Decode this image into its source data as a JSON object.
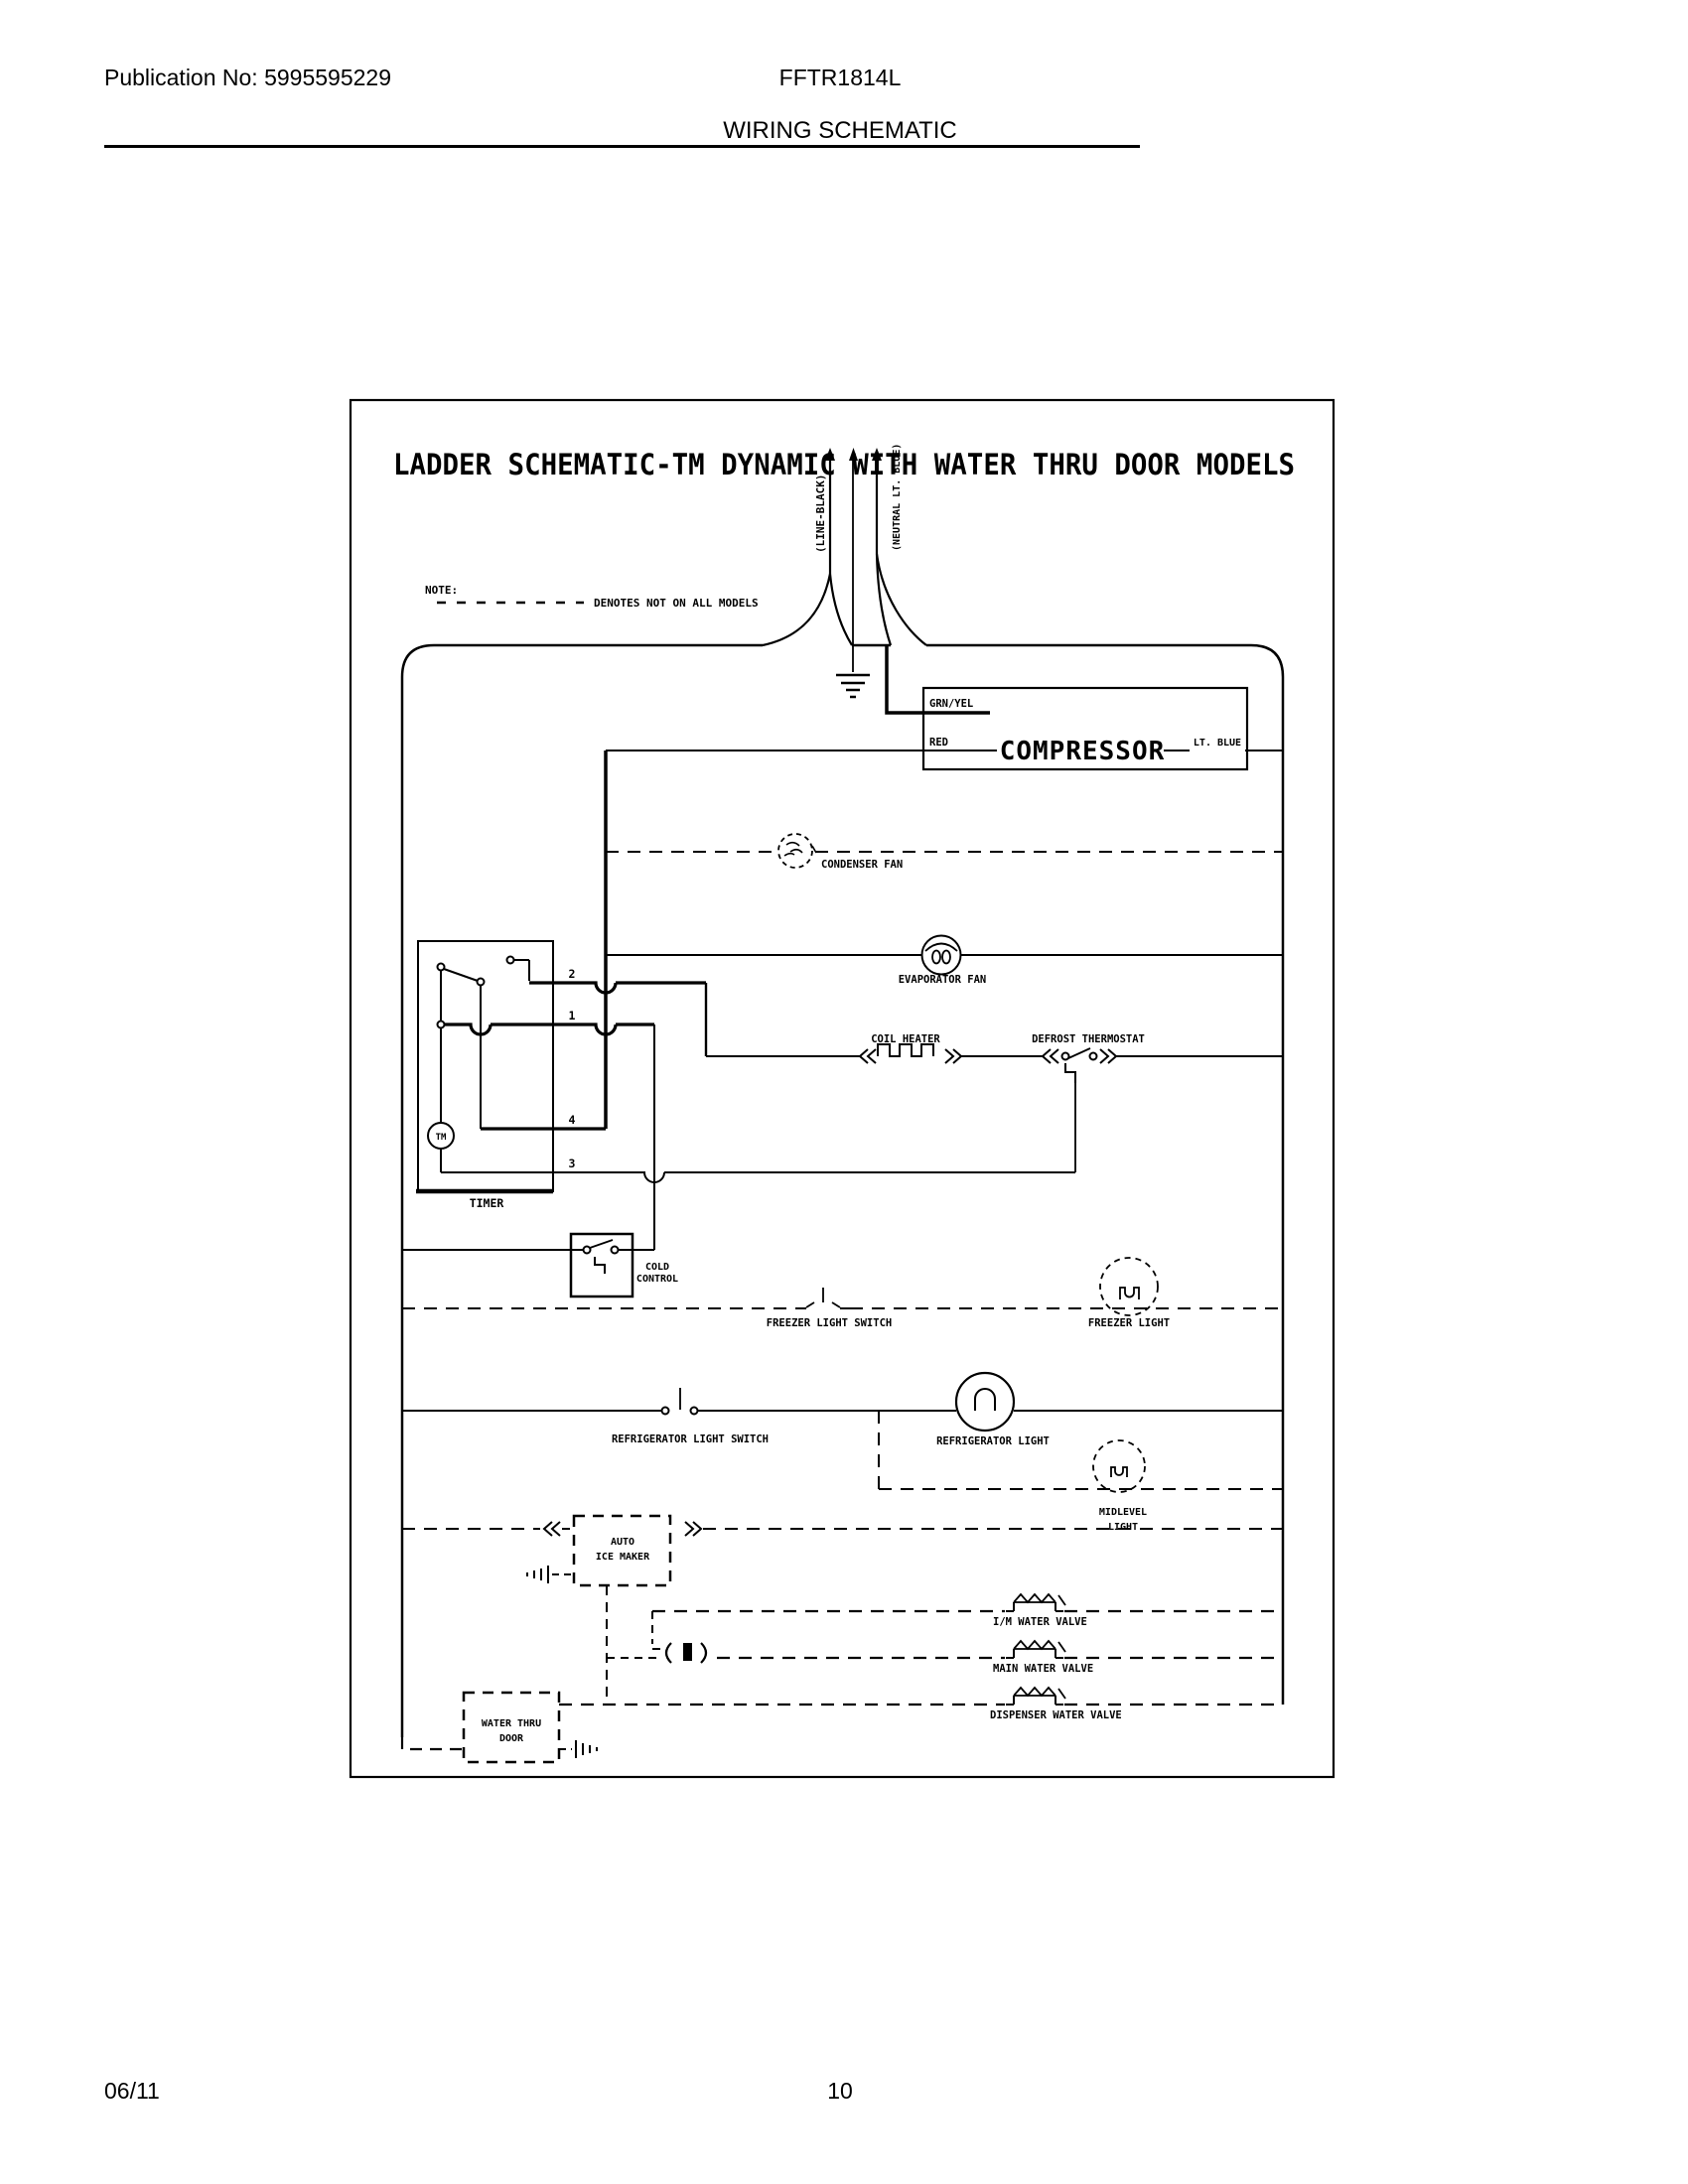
{
  "page": {
    "header": {
      "publication": "Publication No: 5995595229",
      "model": "FFTR1814L",
      "doc_title": "WIRING SCHEMATIC"
    },
    "footer": {
      "date": "06/11",
      "page_number": "10"
    }
  },
  "schematic": {
    "title": "LADDER SCHEMATIC-TM DYNAMIC WITH WATER THRU DOOR MODELS",
    "note": {
      "label": "NOTE:",
      "text": "DENOTES NOT ON ALL MODELS"
    },
    "supply": {
      "line": "(LINE-BLACK)",
      "neutral": "(NEUTRAL LT. BLUE)"
    },
    "compressor": {
      "name": "COMPRESSOR",
      "wire_ground": "GRN/YEL",
      "wire_start": "RED",
      "wire_run": "LT. BLUE"
    },
    "components": {
      "condenser_fan": "CONDENSER FAN",
      "evaporator_fan": "EVAPORATOR FAN",
      "coil_heater": "COIL HEATER",
      "defrost_thermostat": "DEFROST THERMOSTAT",
      "timer": {
        "label": "TIMER",
        "motor": "TM",
        "terminals": [
          "2",
          "1",
          "4",
          "3"
        ]
      },
      "cold_control": [
        "COLD",
        "CONTROL"
      ],
      "freezer_light_switch": "FREEZER LIGHT SWITCH",
      "freezer_light": "FREEZER LIGHT",
      "refrigerator_light_switch": "REFRIGERATOR LIGHT SWITCH",
      "refrigerator_light": "REFRIGERATOR LIGHT",
      "midlevel_light": [
        "MIDLEVEL",
        "LIGHT"
      ],
      "auto_ice_maker": [
        "AUTO",
        "ICE MAKER"
      ],
      "im_water_valve": "I/M WATER VALVE",
      "main_water_valve": "MAIN WATER VALVE",
      "dispenser_water_valve": "DISPENSER WATER VALVE",
      "water_thru_door": [
        "WATER THRU",
        "DOOR"
      ]
    }
  }
}
